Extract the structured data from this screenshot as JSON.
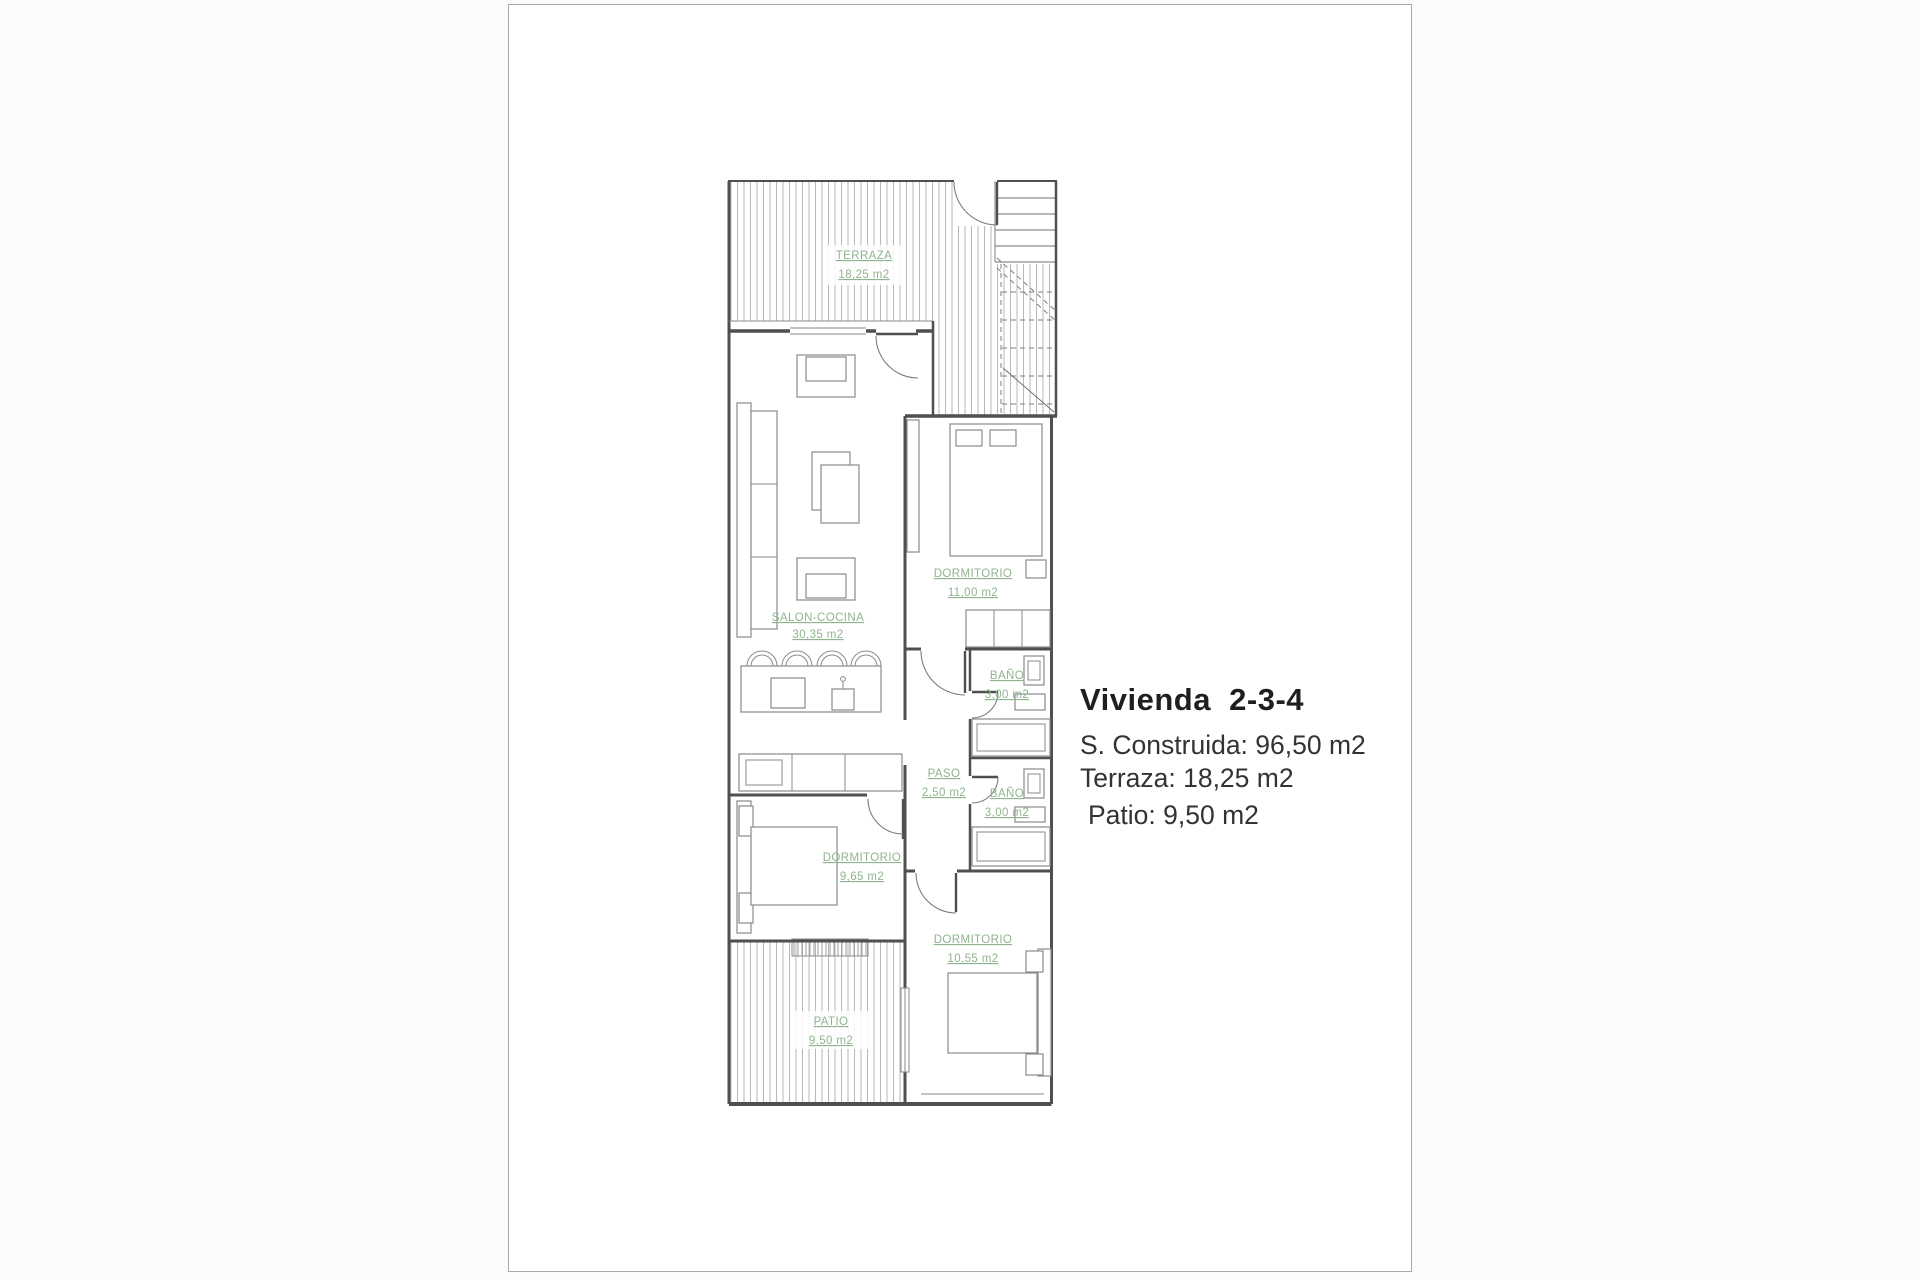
{
  "sheet": {
    "background": "#ffffff",
    "border_color": "#ababab"
  },
  "info_panel": {
    "title": "Vivienda  2-3-4",
    "construida": "S. Construida: 96,50 m2",
    "terraza": "Terraza: 18,25 m2",
    "patio": "Patio: 9,50 m2"
  },
  "floor_plan": {
    "label_color": "#8fb48f",
    "wall_color": "#4f4f4f",
    "furniture_color": "#8a8a8a",
    "hatch_color": "#b7b7b7",
    "rooms": [
      {
        "id": "terraza",
        "name": "TERRAZA",
        "area": "18,25 m2"
      },
      {
        "id": "salon-cocina",
        "name": "SALON-COCINA",
        "area": "30,35 m2"
      },
      {
        "id": "dormitorio-1",
        "name": "DORMITORIO",
        "area": "11,00 m2"
      },
      {
        "id": "bano-1",
        "name": "BAÑO",
        "area": "3,00 m2"
      },
      {
        "id": "paso",
        "name": "PASO",
        "area": "2,50 m2"
      },
      {
        "id": "bano-2",
        "name": "BAÑO",
        "area": "3,00 m2"
      },
      {
        "id": "dormitorio-2",
        "name": "DORMITORIO",
        "area": "9,65 m2"
      },
      {
        "id": "dormitorio-3",
        "name": "DORMITORIO",
        "area": "10,55 m2"
      },
      {
        "id": "patio",
        "name": "PATIO",
        "area": "9,50 m2"
      }
    ]
  }
}
